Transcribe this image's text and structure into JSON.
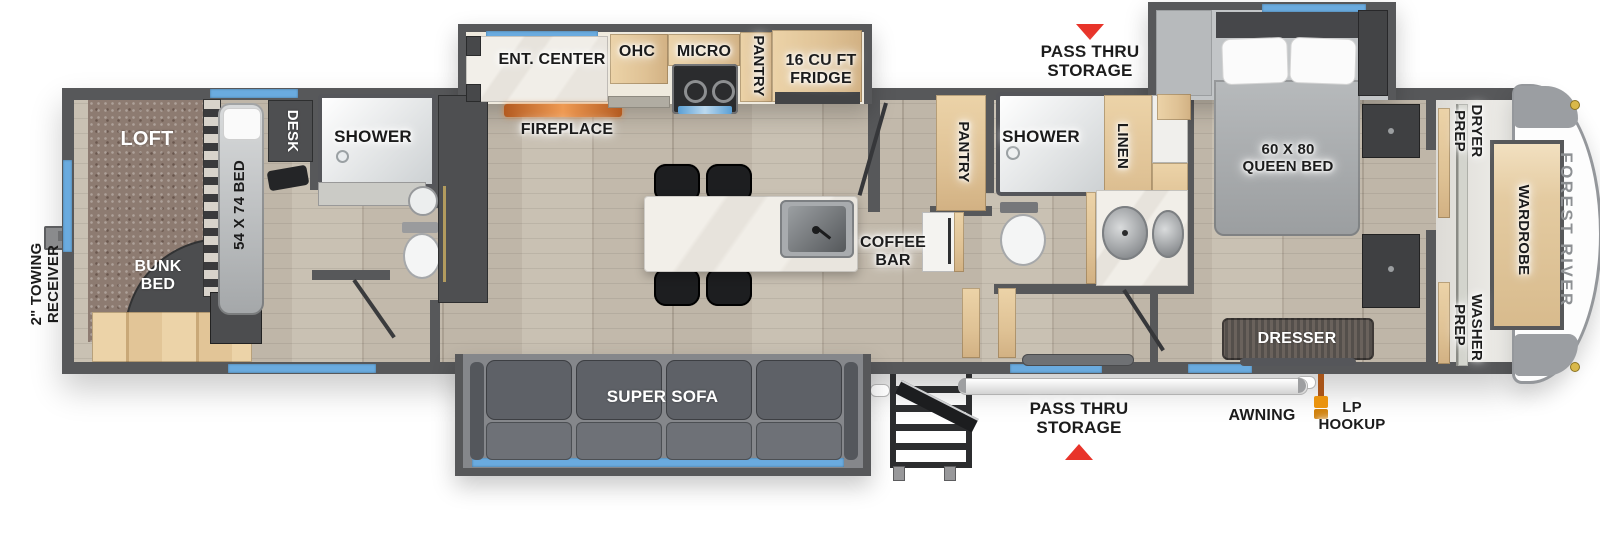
{
  "brand": "FOREST RIVER",
  "exterior": {
    "towing_receiver": "2\" TOWING RECEIVER",
    "pass_thru_top": "PASS THRU STORAGE",
    "pass_thru_bottom": "PASS THRU STORAGE",
    "awning": "AWNING",
    "lp_hookup": "LP HOOKUP"
  },
  "rear_bedroom": {
    "loft": "LOFT",
    "bunk_bed": "BUNK BED",
    "bed": "54 X 74 BED",
    "desk": "DESK",
    "shower": "SHOWER"
  },
  "kitchen": {
    "ent_center": "ENT. CENTER",
    "ohc": "OHC",
    "micro": "MICRO",
    "pantry": "PANTRY",
    "fridge": "16 CU FT FRIDGE",
    "fireplace": "FIREPLACE",
    "coffee_bar": "COFFEE BAR"
  },
  "mid_bath": {
    "pantry": "PANTRY",
    "shower": "SHOWER",
    "linen": "LINEN"
  },
  "front_bedroom": {
    "queen_bed": "60 X 80 QUEEN BED",
    "dresser": "DRESSER",
    "dryer_prep": "DRYER PREP",
    "washer_prep": "WASHER PREP",
    "wardrobe": "WARDROBE"
  },
  "living": {
    "super_sofa": "SUPER SOFA"
  },
  "colors": {
    "wall": "#57585a",
    "floor": "#bcb3a5",
    "carpet": "#8d7b71",
    "cabinet_wood": "#e3c89e",
    "window_blue": "#6aabdf",
    "arrow_red": "#e8342a",
    "fireplace_orange": "#d0712f",
    "lp_orange": "#e8920c",
    "sofa_gray": "#63666c",
    "mattress_gray": "#a7aaac",
    "brand_gray": "#8d9093"
  }
}
